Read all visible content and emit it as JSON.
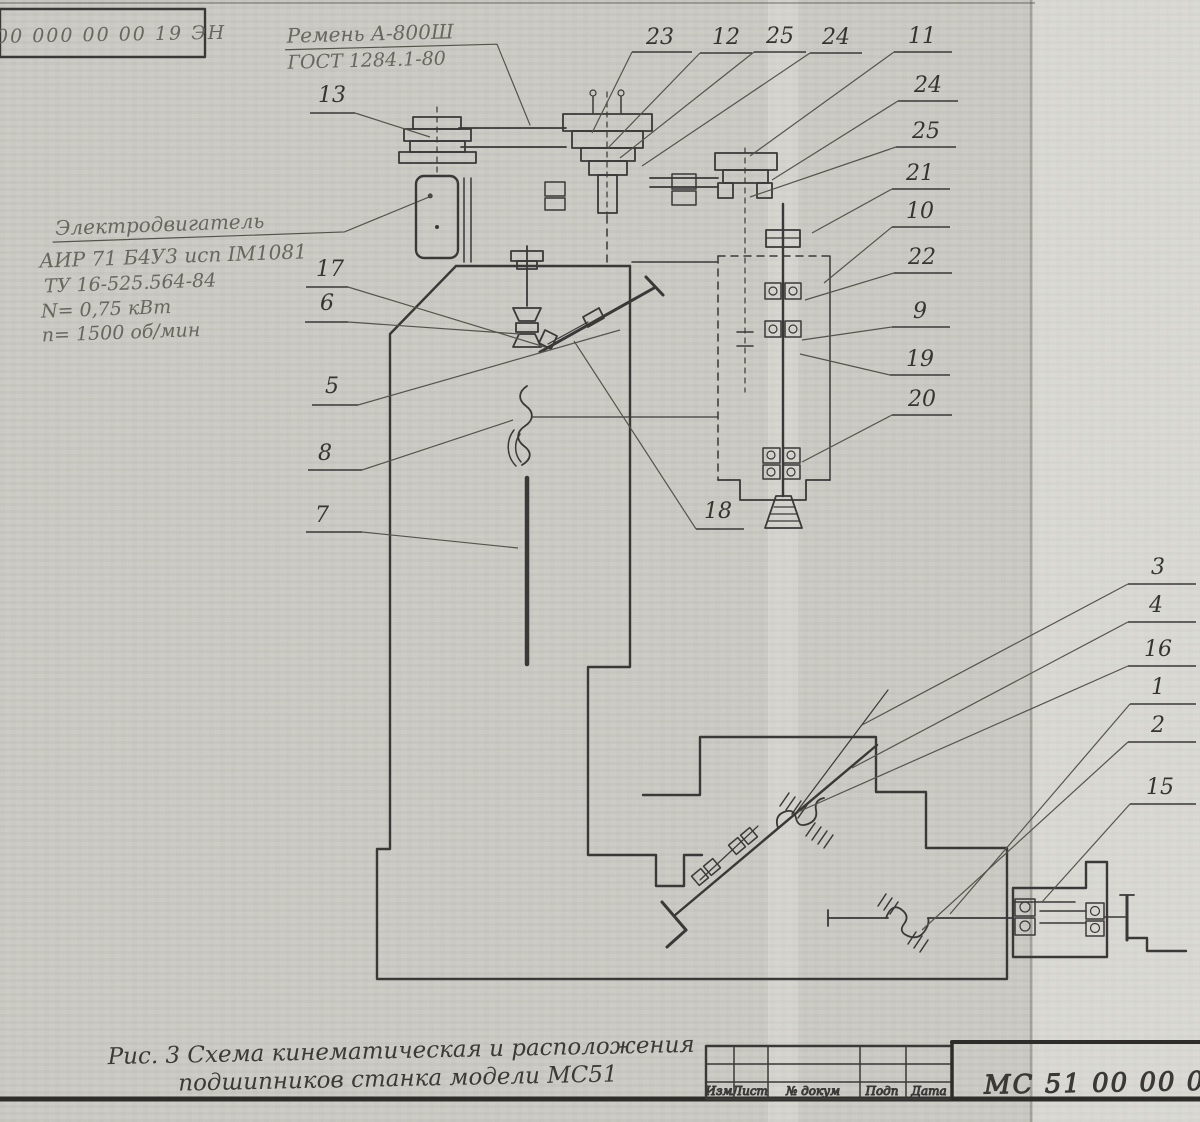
{
  "colors": {
    "ink": "#3a3938",
    "faded_ink": "#67665f",
    "paper": "#d3d2cc"
  },
  "stamp": {
    "code": "00 000 00 00 19 ЭН"
  },
  "belt_label": {
    "line1": "Ремень А-800Ш",
    "line2": "ГОСТ 1284.1-80"
  },
  "motor_label": {
    "title": "Электродвигатель",
    "line2": "АИР 71 Б4У3 исп IM1081",
    "line3": "ТУ 16-525.564-84",
    "line4": "N= 0,75 кВт",
    "line5": "n= 1500 об/мин"
  },
  "caption": {
    "line1": "Рис. 3  Схема кинематическая и расположения",
    "line2": "подшипников  станка модели МС51"
  },
  "title_block": {
    "columns": [
      "Изм",
      "Лист",
      "№ докум",
      "Подп",
      "Дата"
    ],
    "document_number": "МС 51 00 00 000 0"
  },
  "callouts": [
    {
      "label": "13",
      "x": 332,
      "y": 102,
      "ul": [
        310,
        355,
        113
      ],
      "leader": [
        355,
        113,
        430,
        137
      ]
    },
    {
      "label": "17",
      "x": 330,
      "y": 276,
      "ul": [
        306,
        348,
        287
      ],
      "leader": [
        348,
        287,
        545,
        347
      ]
    },
    {
      "label": "6",
      "x": 327,
      "y": 310,
      "ul": [
        305,
        348,
        322
      ],
      "leader": [
        348,
        322,
        520,
        334
      ]
    },
    {
      "label": "5",
      "x": 332,
      "y": 393,
      "ul": [
        312,
        358,
        405
      ],
      "leader": [
        358,
        405,
        620,
        330
      ]
    },
    {
      "label": "8",
      "x": 325,
      "y": 460,
      "s": 30,
      "ul": [
        308,
        362,
        470
      ],
      "leader": [
        362,
        470,
        513,
        420
      ]
    },
    {
      "label": "7",
      "x": 322,
      "y": 522,
      "s": 30,
      "ul": [
        306,
        362,
        532
      ],
      "leader": [
        362,
        532,
        518,
        548
      ]
    },
    {
      "label": "23",
      "x": 660,
      "y": 44,
      "ul": [
        632,
        692,
        52
      ],
      "leader": [
        632,
        52,
        592,
        133
      ]
    },
    {
      "label": "12",
      "x": 726,
      "y": 44,
      "ul": [
        700,
        752,
        53
      ],
      "leader": [
        700,
        53,
        608,
        148
      ]
    },
    {
      "label": "25",
      "x": 780,
      "y": 43,
      "ul": [
        754,
        806,
        52
      ],
      "leader": [
        754,
        52,
        620,
        158
      ]
    },
    {
      "label": "24",
      "x": 836,
      "y": 44,
      "ul": [
        810,
        862,
        53
      ],
      "leader": [
        810,
        53,
        642,
        166
      ]
    },
    {
      "label": "11",
      "x": 922,
      "y": 43,
      "ul": [
        894,
        952,
        52
      ],
      "leader": [
        894,
        52,
        750,
        156
      ]
    },
    {
      "label": "24",
      "x": 928,
      "y": 92,
      "ul": [
        898,
        958,
        101
      ],
      "leader": [
        898,
        101,
        772,
        180
      ]
    },
    {
      "label": "25",
      "x": 926,
      "y": 138,
      "ul": [
        896,
        956,
        147
      ],
      "leader": [
        896,
        147,
        750,
        197
      ]
    },
    {
      "label": "21",
      "x": 920,
      "y": 180,
      "ul": [
        892,
        950,
        189
      ],
      "leader": [
        892,
        189,
        812,
        233
      ]
    },
    {
      "label": "10",
      "x": 920,
      "y": 218,
      "ul": [
        892,
        950,
        227
      ],
      "leader": [
        892,
        227,
        824,
        283
      ]
    },
    {
      "label": "22",
      "x": 922,
      "y": 264,
      "ul": [
        894,
        952,
        273
      ],
      "leader": [
        894,
        273,
        805,
        300
      ]
    },
    {
      "label": "9",
      "x": 920,
      "y": 318,
      "ul": [
        892,
        950,
        327
      ],
      "leader": [
        892,
        327,
        802,
        340
      ]
    },
    {
      "label": "19",
      "x": 920,
      "y": 366,
      "ul": [
        890,
        950,
        375
      ],
      "leader": [
        890,
        375,
        800,
        354
      ]
    },
    {
      "label": "20",
      "x": 922,
      "y": 406,
      "ul": [
        892,
        952,
        415
      ],
      "leader": [
        892,
        415,
        802,
        462
      ]
    },
    {
      "label": "18",
      "x": 718,
      "y": 518,
      "ul": [
        696,
        744,
        529
      ],
      "leader": [
        696,
        529,
        574,
        341
      ]
    },
    {
      "label": "3",
      "x": 1158,
      "y": 574,
      "ul": [
        1128,
        1196,
        584
      ],
      "leader": [
        1128,
        584,
        862,
        725
      ]
    },
    {
      "label": "4",
      "x": 1156,
      "y": 612,
      "ul": [
        1128,
        1196,
        622
      ],
      "leader": [
        1128,
        622,
        852,
        768
      ]
    },
    {
      "label": "16",
      "x": 1158,
      "y": 656,
      "ul": [
        1128,
        1196,
        666
      ],
      "leader": [
        1128,
        666,
        798,
        812
      ]
    },
    {
      "label": "1",
      "x": 1158,
      "y": 694,
      "ul": [
        1130,
        1196,
        704
      ],
      "leader": [
        1130,
        704,
        950,
        914
      ]
    },
    {
      "label": "2",
      "x": 1158,
      "y": 732,
      "ul": [
        1128,
        1196,
        742
      ],
      "leader": [
        1128,
        742,
        922,
        930
      ]
    },
    {
      "label": "15",
      "x": 1160,
      "y": 794,
      "ul": [
        1130,
        1196,
        804
      ],
      "leader": [
        1130,
        804,
        1042,
        902
      ]
    }
  ]
}
